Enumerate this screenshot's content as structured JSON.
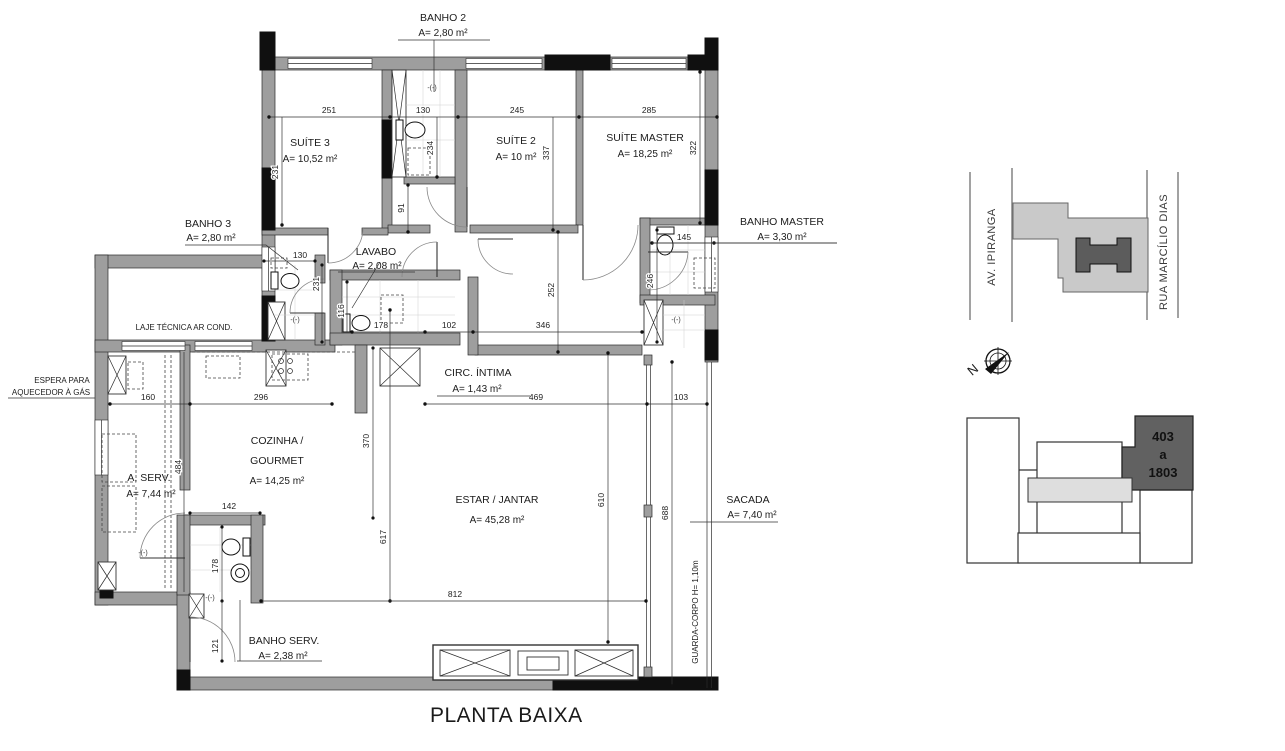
{
  "title": "PLANTA BAIXA",
  "rooms": {
    "banho2": {
      "name": "BANHO 2",
      "area": "A= 2,80 m²"
    },
    "suite3": {
      "name": "SUÍTE 3",
      "area": "A= 10,52 m²"
    },
    "suite2": {
      "name": "SUÍTE 2",
      "area": "A= 10 m²"
    },
    "suite_master": {
      "name": "SUÍTE MASTER",
      "area": "A= 18,25 m²"
    },
    "banho3": {
      "name": "BANHO 3",
      "area": "A= 2,80 m²"
    },
    "lavabo": {
      "name": "LAVABO",
      "area": "A= 2,08 m²"
    },
    "banho_master": {
      "name": "BANHO MASTER",
      "area": "A= 3,30 m²"
    },
    "circ_intima": {
      "name": "CIRC. ÍNTIMA",
      "area": "A= 1,43 m²"
    },
    "cozinha": {
      "line1": "COZINHA /",
      "line2": "GOURMET",
      "area": "A= 14,25 m²"
    },
    "estar": {
      "name": "ESTAR / JANTAR",
      "area": "A= 45,28 m²"
    },
    "aserv": {
      "name": "A. SERV.",
      "area": "A= 7,44 m²"
    },
    "sacada": {
      "name": "SACADA",
      "area": "A= 7,40 m²"
    },
    "banho_serv": {
      "name": "BANHO SERV.",
      "area": "A= 2,38 m²"
    }
  },
  "labels": {
    "laje": "LAJE TÉCNICA AR COND.",
    "espera1": "ESPERA PARA",
    "espera2": "AQUECEDOR À GÁS",
    "guarda": "GUARDA-CORPO H= 1,10m",
    "valve": "-(-)",
    "north": "N"
  },
  "dims": {
    "s3_w": "251",
    "b2_w": "130",
    "s2_w": "245",
    "sm_w": "285",
    "s3_h": "231",
    "b2_h": "234",
    "s2_h": "337",
    "sm_h": "322",
    "shaft_h": "91",
    "b3_w": "130",
    "b3_h": "231",
    "lav_h": "116",
    "lav_w": "178",
    "circ_w": "102",
    "hall_w": "346",
    "hall_h": "252",
    "bm_w": "145",
    "bm_h": "246",
    "aserv_w": "160",
    "coz_w": "296",
    "estar_top": "469",
    "sac_top": "103",
    "coz_h": "370",
    "aserv_h": "484",
    "bserv_w": "142",
    "bserv_h": "178",
    "bserv_low": "121",
    "estar_h": "617",
    "estar_w": "812",
    "estar_r": "610",
    "sac_h": "688"
  },
  "map": {
    "street_left": "AV. IPIRANGA",
    "street_right": "RUA MARCÍLIO DIAS"
  },
  "keyplan": {
    "unit_line1": "403",
    "unit_line2": "a",
    "unit_line3": "1803"
  }
}
